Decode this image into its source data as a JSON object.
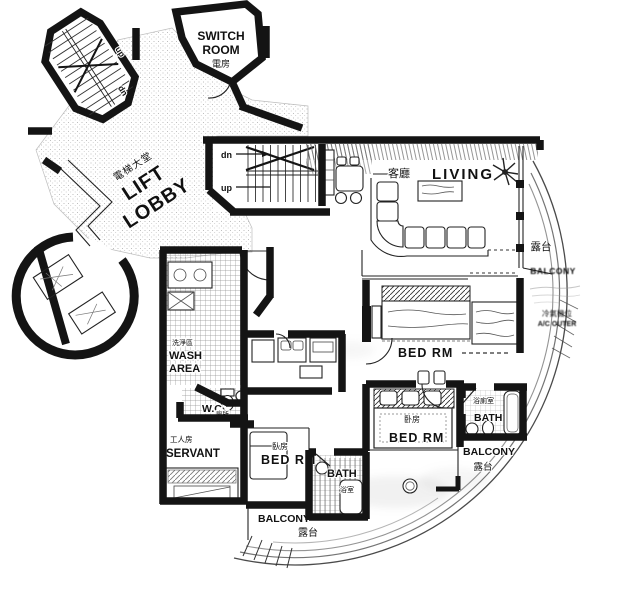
{
  "palette": {
    "ink": "#141414",
    "paper": "#ffffff"
  },
  "rooms": {
    "lift_lobby": {
      "zh": "電梯大堂",
      "en1": "LIFT",
      "en2": "LOBBY"
    },
    "switch_room": {
      "en1": "SWITCH",
      "en2": "ROOM",
      "zh": "電房"
    },
    "living": {
      "zh": "客廳",
      "en": "LIVING"
    },
    "bed_upper": {
      "en": "BED RM"
    },
    "bed_center": {
      "zh": "卧房",
      "en": "BED RM"
    },
    "bed_lower": {
      "zh": "臥房",
      "en": "BED RM"
    },
    "bath_right": {
      "zh": "浴廁室",
      "en": "BATH"
    },
    "bath_lower": {
      "en": "BATH",
      "zh": "浴室"
    },
    "wash_area": {
      "zh": "洗淨區",
      "en1": "WASH",
      "en2": "AREA"
    },
    "wc": {
      "en": "W.C",
      "zh": "廁所"
    },
    "servant": {
      "zh": "工人房",
      "en": "SERVANT"
    },
    "balcony_upper_right": {
      "zh": "露台",
      "en": "BALCONY"
    },
    "balcony_lower_right": {
      "en": "BALCONY",
      "zh": "露台"
    },
    "balcony_bottom": {
      "en": "BALCONY",
      "zh": "露台"
    }
  },
  "stairs": {
    "up": "up",
    "dn": "dn"
  },
  "annotations": {
    "ac_zh": "冷氣機位",
    "ac_en": "A/C OUTER"
  }
}
